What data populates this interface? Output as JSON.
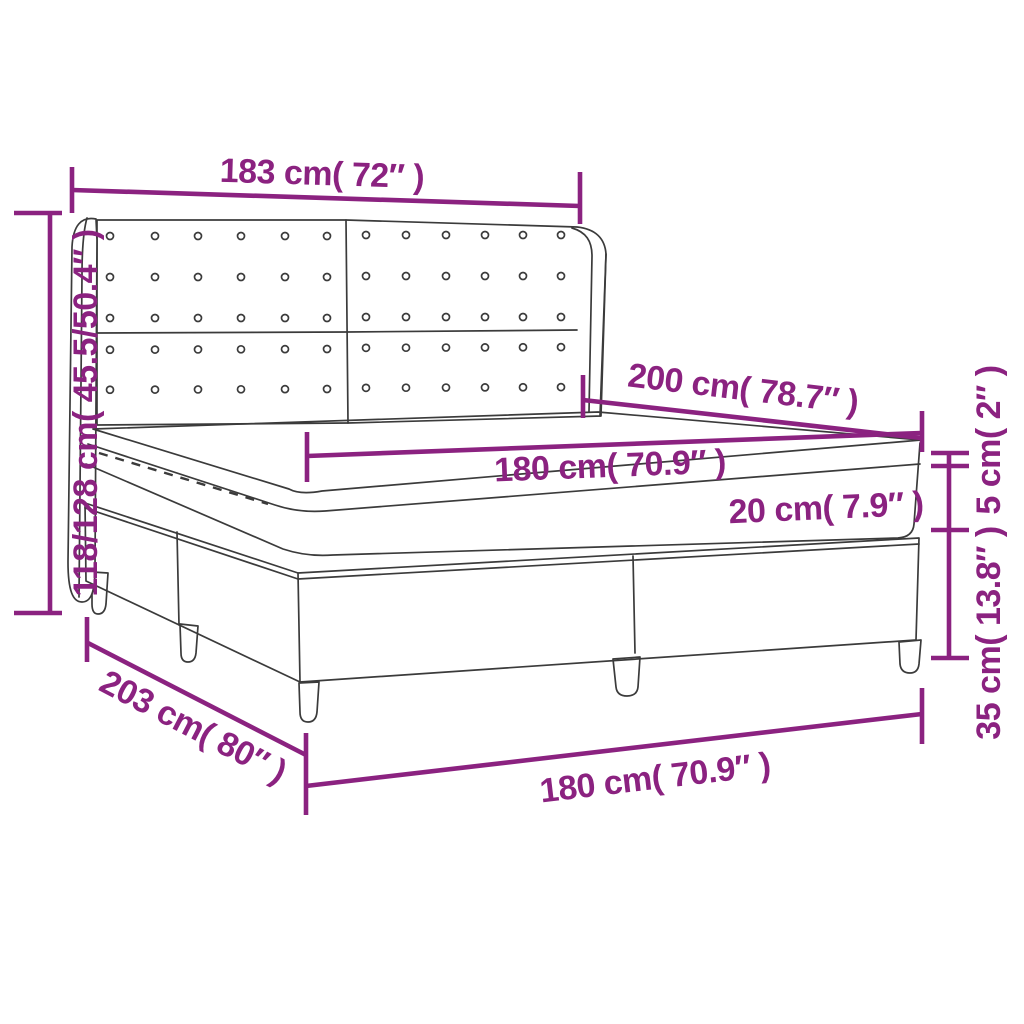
{
  "diagram": {
    "subject": "box-spring-bed-with-headboard-dimension-diagram",
    "colors": {
      "dimension_accent": "#8B2280",
      "line_art": "#3b3b3b",
      "background": "#ffffff"
    },
    "dims": {
      "headboard_width": {
        "label": "183 cm( 72″ )"
      },
      "total_height": {
        "label": "118/128 cm( 45.5/50.4″ )"
      },
      "depth": {
        "label": "200 cm( 78.7″ )"
      },
      "mattress_width": {
        "label": "180 cm( 70.9″ )"
      },
      "mattress_height": {
        "label": "20 cm( 7.9″ )"
      },
      "topper_height": {
        "label": "5 cm( 2″ )"
      },
      "base_height": {
        "label": "35 cm( 13.8″ )"
      },
      "base_depth": {
        "label": "203 cm( 80″ )"
      },
      "base_width": {
        "label": "180 cm( 70.9″ )"
      }
    }
  }
}
